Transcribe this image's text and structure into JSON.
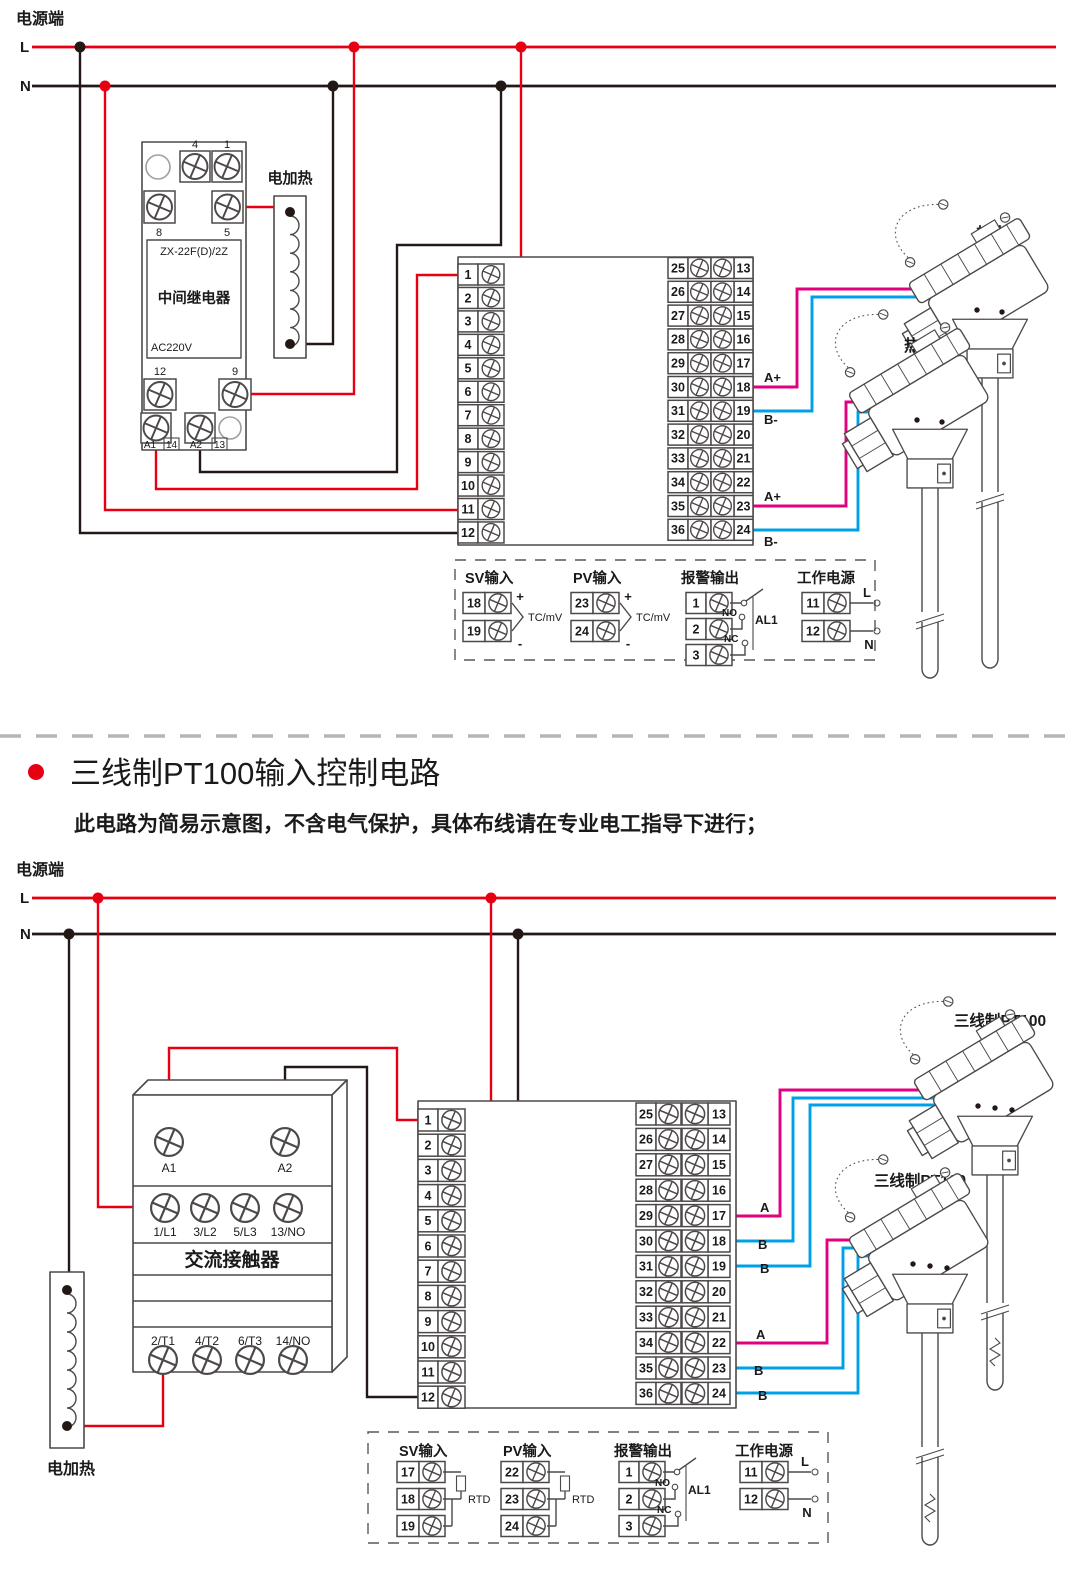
{
  "colors": {
    "accent_red": "#e60012",
    "wire_magenta": "#e3007f",
    "wire_blue": "#00a0e9",
    "line_black": "#231815",
    "device_grey": "#4c4948"
  },
  "power_top": {
    "label": "电源端",
    "l": "L",
    "n": "N"
  },
  "power_bottom": {
    "label": "电源端",
    "l": "L",
    "n": "N"
  },
  "section": {
    "title": "三线制PT100输入控制电路",
    "subtitle": "此电路为简易示意图，不含电气保护，具体布线请在专业电工指导下进行；"
  },
  "top": {
    "relay": {
      "model": "ZX-22F(D)/2Z",
      "name": "中间继电器",
      "voltage": "AC220V",
      "t4": "4",
      "t1": "1",
      "t8": "8",
      "t5": "5",
      "t12": "12",
      "t9": "9",
      "a1": "A1",
      "t14": "14",
      "a2": "A2",
      "t13": "13"
    },
    "heater": "电加热",
    "sensor1": "热电偶",
    "sensor2": "热电偶",
    "labels": {
      "l18": "A+",
      "l19": "B-",
      "l23": "A+",
      "l24": "B-"
    },
    "terms_left": [
      "1",
      "2",
      "3",
      "4",
      "5",
      "6",
      "7",
      "8",
      "9",
      "10",
      "11",
      "12"
    ],
    "terms_mid": [
      "25",
      "26",
      "27",
      "28",
      "29",
      "30",
      "31",
      "32",
      "33",
      "34",
      "35",
      "36"
    ],
    "terms_right": [
      "13",
      "14",
      "15",
      "16",
      "17",
      "18",
      "19",
      "20",
      "21",
      "22",
      "23",
      "24"
    ],
    "legend": {
      "sv": {
        "title": "SV输入",
        "r1": "18",
        "r2": "19",
        "plus": "+",
        "minus": "-",
        "type": "TC/mV"
      },
      "pv": {
        "title": "PV输入",
        "r1": "23",
        "r2": "24",
        "plus": "+",
        "minus": "-",
        "type": "TC/mV"
      },
      "alarm": {
        "title": "报警输出",
        "r1": "1",
        "r2": "2",
        "r3": "3",
        "no": "NO",
        "nc": "NC",
        "name": "AL1"
      },
      "power": {
        "title": "工作电源",
        "r1": "11",
        "r2": "12",
        "l": "L",
        "n": "N"
      }
    }
  },
  "bottom": {
    "contactor": {
      "name": "交流接触器",
      "a1": "A1",
      "a2": "A2",
      "l1": "1/L1",
      "l2": "3/L2",
      "l3": "5/L3",
      "no1": "13/NO",
      "t1": "2/T1",
      "t2": "4/T2",
      "t3": "6/T3",
      "no2": "14/NO"
    },
    "heater": "电加热",
    "sensor1": "三线制PT100",
    "sensor2": "三线制PT100",
    "labels": {
      "l17": "A",
      "l18": "B",
      "l19": "B",
      "l22": "A",
      "l23": "B",
      "l24": "B"
    },
    "terms_left": [
      "1",
      "2",
      "3",
      "4",
      "5",
      "6",
      "7",
      "8",
      "9",
      "10",
      "11",
      "12"
    ],
    "terms_mid": [
      "25",
      "26",
      "27",
      "28",
      "29",
      "30",
      "31",
      "32",
      "33",
      "34",
      "35",
      "36"
    ],
    "terms_right": [
      "13",
      "14",
      "15",
      "16",
      "17",
      "18",
      "19",
      "20",
      "21",
      "22",
      "23",
      "24"
    ],
    "legend": {
      "sv": {
        "title": "SV输入",
        "r1": "17",
        "r2": "18",
        "r3": "19",
        "type": "RTD"
      },
      "pv": {
        "title": "PV输入",
        "r1": "22",
        "r2": "23",
        "r3": "24",
        "type": "RTD"
      },
      "alarm": {
        "title": "报警输出",
        "r1": "1",
        "r2": "2",
        "r3": "3",
        "no": "NO",
        "nc": "NC",
        "name": "AL1"
      },
      "power": {
        "title": "工作电源",
        "r1": "11",
        "r2": "12",
        "l": "L",
        "n": "N"
      }
    }
  }
}
